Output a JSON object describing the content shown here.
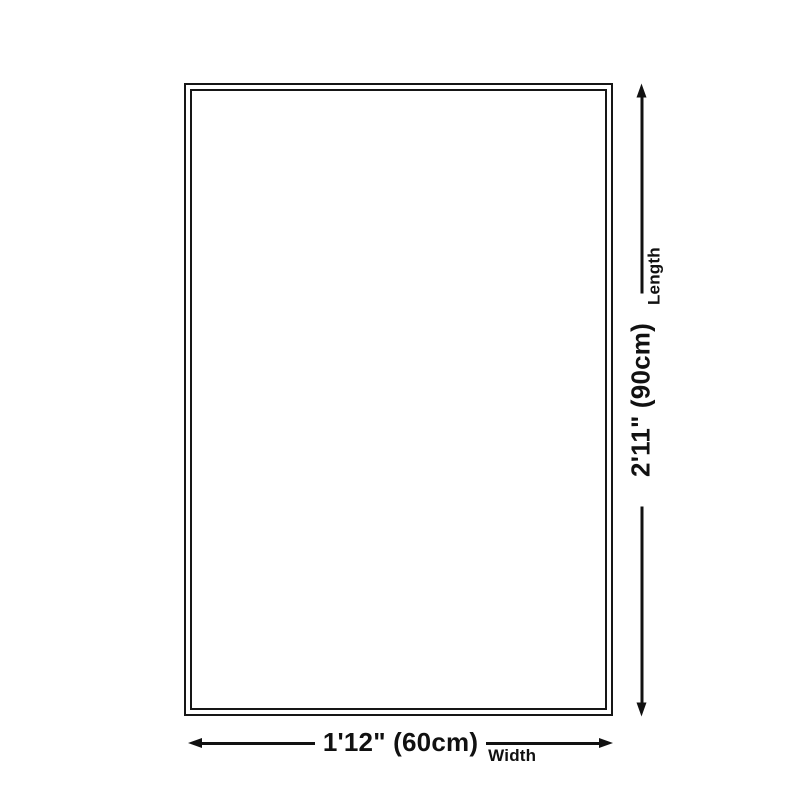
{
  "diagram": {
    "type": "rug-size-diagram",
    "background_color": "#ffffff",
    "line_color": "#111111",
    "dimensions": {
      "width": {
        "value": "1'12\" (60cm)",
        "label": "Width"
      },
      "length": {
        "value": "2'11\" (90cm)",
        "label": "Length"
      }
    }
  }
}
